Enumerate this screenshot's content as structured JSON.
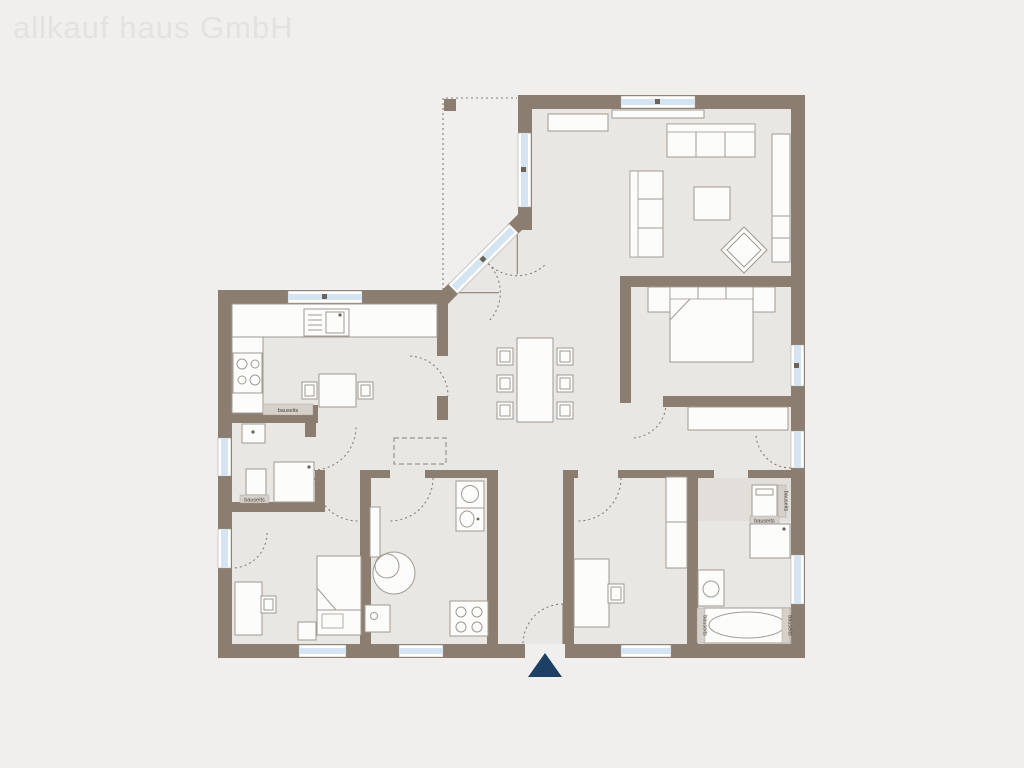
{
  "watermark": {
    "text": "allkauf haus GmbH"
  },
  "labels": {
    "bauseits": "bauseits"
  },
  "icons": {
    "entrance_arrow": "triangle-up-icon"
  },
  "colors": {
    "background": "#f0efed",
    "floor": "#e9e7e3",
    "wall": "#8b7d6f",
    "window_glass": "#d4e4f2",
    "window_frame": "#ffffff",
    "window_dot": "#6c6257",
    "furniture_fill": "#fcfcfb",
    "furniture_stroke": "#a19a92",
    "label_bg": "#d5d0c9",
    "label_text": "#45403a",
    "entrance_arrow": "#1d3f63",
    "watermark_text": "#e4e2df",
    "arc": "#8b7d6f"
  }
}
